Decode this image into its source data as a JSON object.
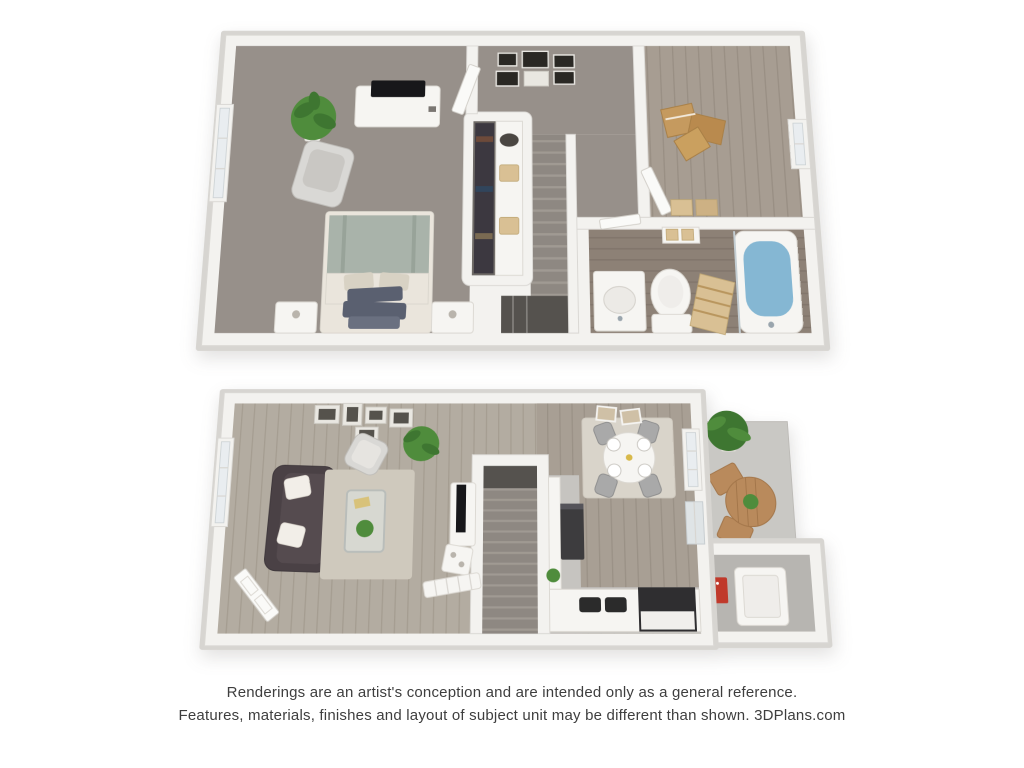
{
  "disclaimer": {
    "line1": "Renderings are an artist's conception and are intended only as a general reference.",
    "line2": "Features, materials, finishes and layout of subject unit may be different than shown. 3DPlans.com"
  },
  "colors": {
    "text": "#3e3e3e",
    "rim": "#d7d5d1",
    "wall": "#f3f2ef",
    "wallEdge": "#dad8d4",
    "carpet": "#97908a",
    "stair": "#8e8882",
    "stairEdge": "#a09a93",
    "stairDark": "#55524e",
    "woodRoom2": "#a79d92",
    "woodRoom2Line": "#998f84",
    "woodBath": "#8d8176",
    "woodBathLine": "#80746a",
    "woodLiving": "#b3aca1",
    "woodLivingLine": "#a59d91",
    "woodDining": "#a89f94",
    "woodDiningLine": "#9a9186",
    "concrete": "#c9c8c4",
    "concreteDark": "#b7b5b1",
    "kitchenFloor": "#c6c4c0",
    "closetFloor": "#6e6a66",
    "clothes": "#3c3840",
    "door": "#fafaf8",
    "windowGlass": "#e9edf0",
    "whiteFurn": "#f6f5f2",
    "darkFurn": "#3d3c3e",
    "tv": "#17171a",
    "sofa": "#4a4145",
    "pillow": "#f2eee8",
    "sage": "#a9b3aa",
    "cream": "#eae5dc",
    "slate": "#5a6070",
    "rug": "#cfc9bd",
    "rugLight": "#d9d4ca",
    "glass": "#dfe3e2",
    "water": "#85b7d3",
    "green": "#4f8c3c",
    "greenDark": "#3e7631",
    "bistro": "#b98a5c",
    "cardboard": "#c59a5f",
    "tan": "#d9c094",
    "red": "#c0392b",
    "chairGray": "#a9a9a9",
    "chairLight": "#d9d8d5"
  },
  "scene": {
    "type": "3d-floor-plan-rendering",
    "floors": [
      {
        "name": "upper-floor",
        "rooms": [
          {
            "name": "bedroom",
            "flooring": "carpet",
            "furniture": [
              "bed",
              "nightstand-left",
              "nightstand-right",
              "dresser-with-tv",
              "accent-chair",
              "potted-plant",
              "window"
            ]
          },
          {
            "name": "walk-in-closet",
            "furniture": [
              "hanging-clothes",
              "shelf-with-baskets"
            ]
          },
          {
            "name": "hallway",
            "furniture": [
              "gallery-picture-frames"
            ]
          },
          {
            "name": "staircase",
            "furniture": []
          },
          {
            "name": "second-room",
            "flooring": "wood",
            "furniture": [
              "moving-boxes",
              "baskets",
              "window"
            ]
          },
          {
            "name": "bathroom",
            "flooring": "wood",
            "furniture": [
              "sink-vanity",
              "toilet",
              "bathtub",
              "towel-stack",
              "wall-shelf"
            ]
          }
        ]
      },
      {
        "name": "lower-floor",
        "rooms": [
          {
            "name": "living-room",
            "flooring": "wood",
            "furniture": [
              "sofa",
              "area-rug",
              "coffee-table",
              "accent-chair",
              "potted-plant",
              "tv-console",
              "side-shelf",
              "entry-bench",
              "gallery-picture-frames",
              "front-door",
              "window"
            ]
          },
          {
            "name": "staircase",
            "furniture": []
          },
          {
            "name": "kitchen",
            "furniture": [
              "refrigerator",
              "counter",
              "double-sink",
              "range"
            ]
          },
          {
            "name": "dining-area",
            "flooring": "wood",
            "furniture": [
              "dining-table",
              "dining-chairs",
              "area-rug",
              "ceiling-lights",
              "window",
              "sliding-door"
            ]
          },
          {
            "name": "patio",
            "flooring": "concrete",
            "furniture": [
              "bistro-table",
              "patio-chairs",
              "potted-plant"
            ]
          },
          {
            "name": "storage-room",
            "flooring": "concrete",
            "furniture": [
              "water-heater",
              "electrical-panel"
            ]
          }
        ]
      }
    ]
  }
}
